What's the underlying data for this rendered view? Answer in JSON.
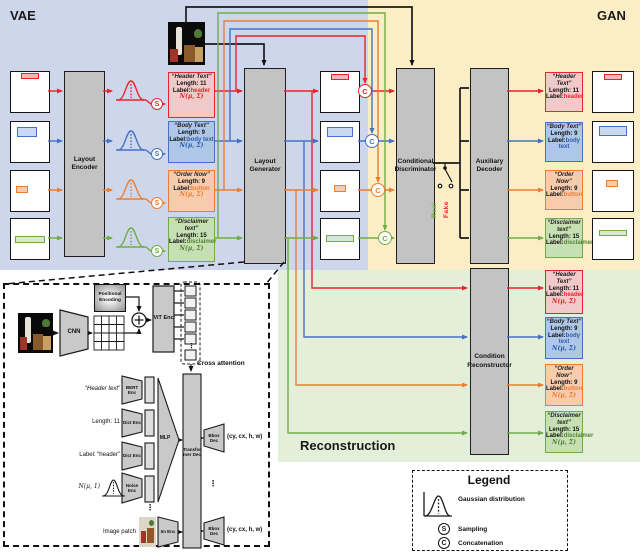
{
  "regions": {
    "vae": "VAE",
    "gan": "GAN",
    "reconstruction": "Reconstruction"
  },
  "region_colors": {
    "vae_bg": "#cdd6ea",
    "gan_bg": "#fbedc5",
    "reconstruction_bg": "#e3efd9"
  },
  "blocks": {
    "layout_encoder": "Layout Encoder",
    "layout_generator": "Layout Generator",
    "conditional_discriminator": "Conditional Discriminator",
    "auxiliary_decoder": "Auxiliary Decoder",
    "condition_reconstructor": "Condition Reconstructor"
  },
  "texts": {
    "label_key": "Label:",
    "gauss_sigma": "N(μ, Σ)",
    "fake": "Fake",
    "real": "Real",
    "dots": "⋮"
  },
  "status_colors": {
    "fake": "#e8252a",
    "real": "#70ad47"
  },
  "conditions": [
    {
      "id": "header",
      "title": "“Header Text”",
      "length": "Length: 11",
      "label": "header",
      "color": "#e8252a",
      "bg": "#f2c9c9"
    },
    {
      "id": "body",
      "title": "“Body Text”",
      "length": "Length: 9",
      "label": "body text",
      "color": "#4472c4",
      "bg": "#aec6e8"
    },
    {
      "id": "button",
      "title": "“Order Now”",
      "length": "Length: 9",
      "label": "button",
      "color": "#ed7d31",
      "bg": "#f8cbad"
    },
    {
      "id": "disclaimer",
      "title": "“Disclaimer text”",
      "length": "Length: 15",
      "label": "disclaimer",
      "color": "#70ad47",
      "bg": "#c6e0b4"
    }
  ],
  "detail": {
    "cnn": "CNN",
    "positional_encoding": "Positional Encoding",
    "vit": "ViT Enc",
    "cross_attention": "Cross attention",
    "rows": [
      {
        "text": "“Header text”",
        "enc": "BERT Enc"
      },
      {
        "text": "Length: 11",
        "enc": "Dict Enc"
      },
      {
        "text": "Label: “header”",
        "enc": "Dict Enc"
      },
      {
        "text": "N(μ, 1)",
        "enc": "Noise Enc"
      }
    ],
    "mlp": "MLP",
    "transformer": "Transformer Dec",
    "image_patch": "Image patch",
    "im_enc": "Im Enc",
    "bbox_dec": "Bbox Dec",
    "bbox_output": "(cy, cx, h, w)"
  },
  "legend": {
    "title": "Legend",
    "s_letter": "S",
    "c_letter": "C",
    "items": [
      {
        "label": "Gaussian distribution"
      },
      {
        "label": "Sampling"
      },
      {
        "label": "Concatenation"
      }
    ]
  }
}
